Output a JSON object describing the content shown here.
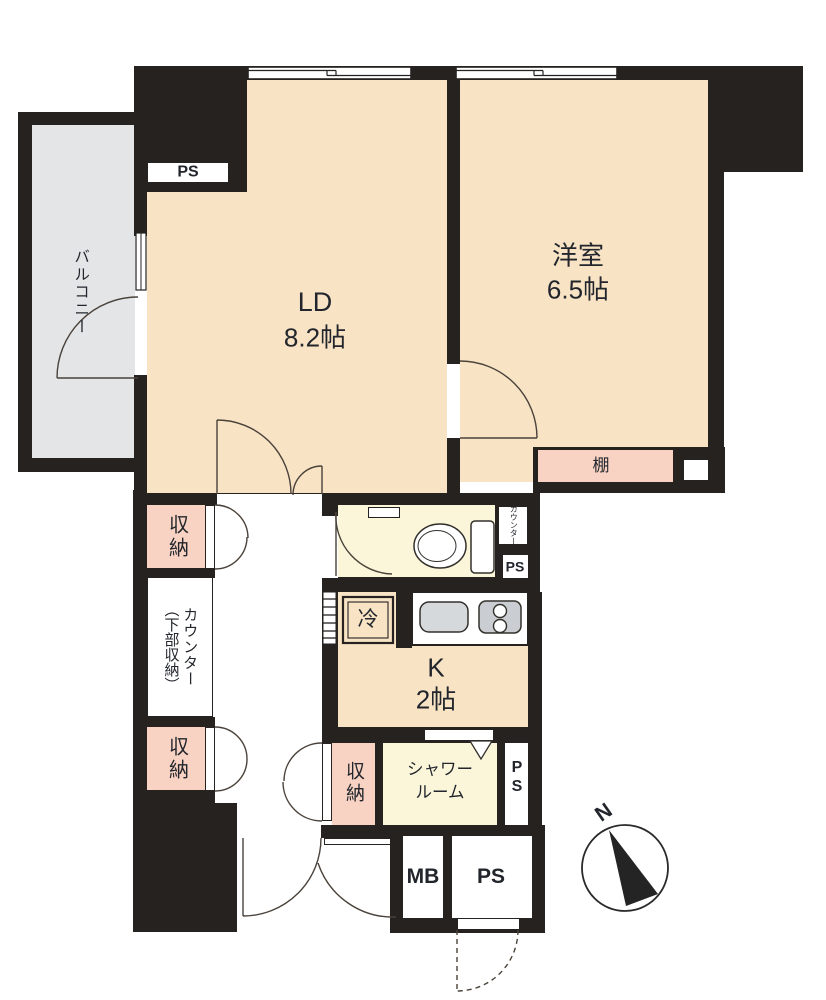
{
  "colors": {
    "wall": "#262220",
    "room_cream": "#f8e3c5",
    "accent_pink": "#f8d3c3",
    "pale_yellow": "#fbf6da",
    "balcony_gray": "#e3e5e7",
    "fixture_gray": "#d6d9db",
    "door_line": "#4a423a"
  },
  "compass": {
    "north_label": "N"
  },
  "rooms": {
    "balcony": {
      "label": "バルコニー"
    },
    "living_dining": {
      "label": "LD",
      "size": "8.2帖"
    },
    "western": {
      "label": "洋室",
      "size": "6.5帖"
    },
    "kitchen": {
      "label": "K",
      "size": "2帖"
    },
    "shower": {
      "line1": "シャワー",
      "line2": "ルーム"
    },
    "storage_label": "収納",
    "shelf_label": "棚",
    "counter": {
      "main": "カウンター",
      "sub": "（下部収納）"
    },
    "counter_small_label": "カウンター",
    "fridge_label": "冷"
  },
  "utilities": {
    "ps_top": "PS",
    "ps_toilet_side": "PS",
    "ps_shower_side": "PS",
    "ps_entrance": "PS",
    "mb": "MB"
  }
}
